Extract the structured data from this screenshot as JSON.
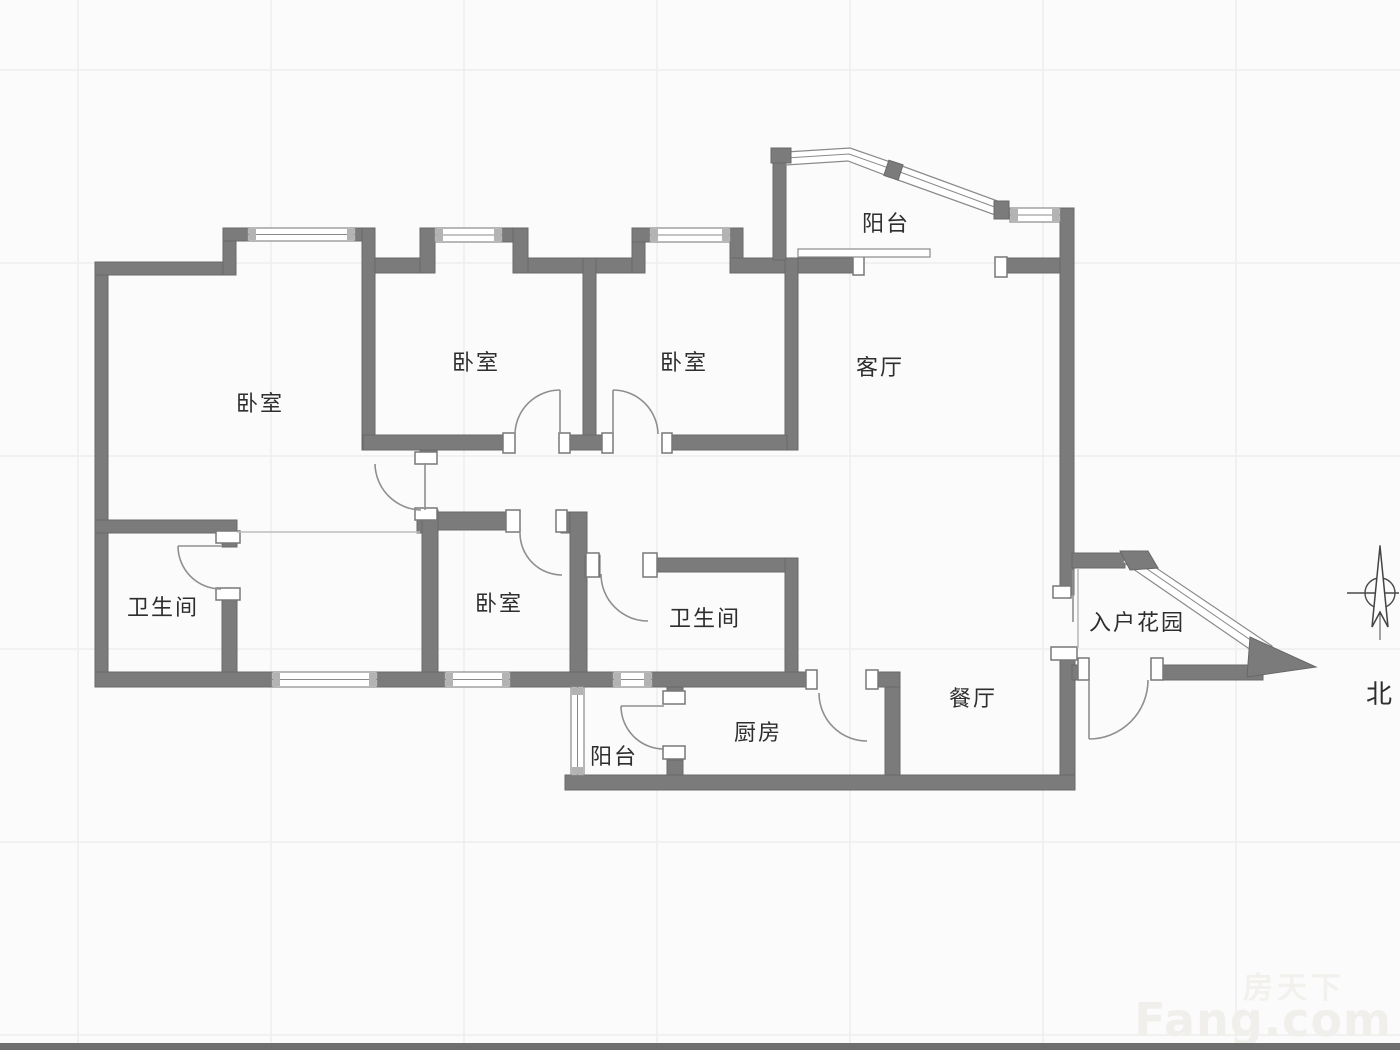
{
  "floorplan": {
    "rooms": [
      {
        "id": "bedroom-master",
        "label": "卧室"
      },
      {
        "id": "bedroom-2",
        "label": "卧室"
      },
      {
        "id": "bedroom-3",
        "label": "卧室"
      },
      {
        "id": "bedroom-4",
        "label": "卧室"
      },
      {
        "id": "bathroom-left",
        "label": "卫生间"
      },
      {
        "id": "bathroom-right",
        "label": "卫生间"
      },
      {
        "id": "living-room",
        "label": "客厅"
      },
      {
        "id": "dining-room",
        "label": "餐厅"
      },
      {
        "id": "kitchen",
        "label": "厨房"
      },
      {
        "id": "balcony-top",
        "label": "阳台"
      },
      {
        "id": "balcony-bottom",
        "label": "阳台"
      },
      {
        "id": "entry-garden",
        "label": "入户花园"
      }
    ],
    "compass": {
      "label": "北"
    },
    "watermark": {
      "brand_cn": "房天下",
      "brand_en": "Fang.com"
    },
    "colors": {
      "wall": "#7b7b7b",
      "wall_edge": "#686868",
      "door_arc": "#8f8f8f",
      "window_line": "#8a8a8a",
      "label_text": "#2e2e2e",
      "grid_line": "#eeeeee",
      "background": "#fbfbfb",
      "bottom_bar": "#6e6e6e"
    }
  }
}
